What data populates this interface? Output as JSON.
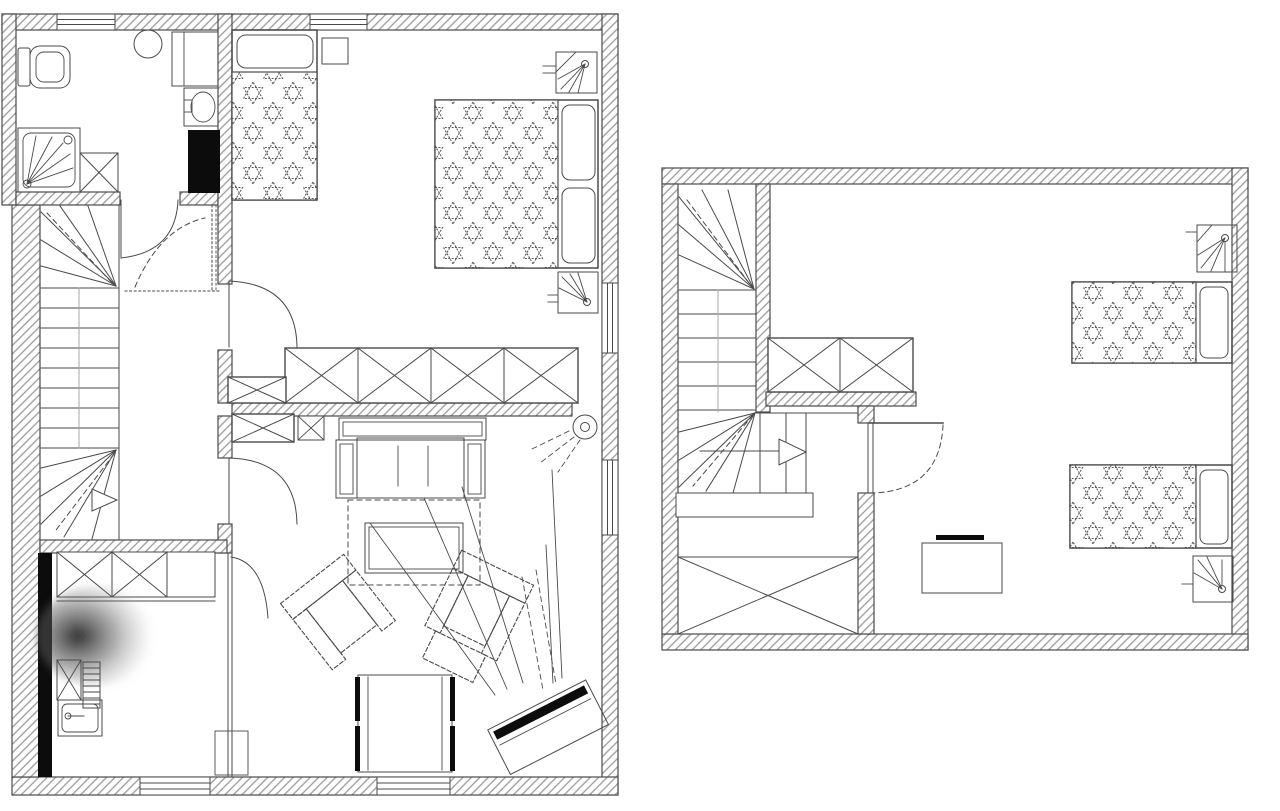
{
  "document": {
    "type": "architectural-floor-plan",
    "drawing_style": "black-and-white line drawing, hatched walls, star-patterned bedding",
    "floors": [
      {
        "name": "ground-floor",
        "position": "left",
        "rooms": [
          {
            "name": "bathroom",
            "fixtures": [
              "toilet",
              "round-sink",
              "washing-machine",
              "wash-basin",
              "black-duct-shaft",
              "shower-cabin",
              "crossed-cabinet",
              "door"
            ]
          },
          {
            "name": "bedroom",
            "furniture": [
              "single-bed-star-blanket",
              "nightstand",
              "double-bed-star-blanket",
              "two-pillows",
              "wall-lamp-top",
              "wall-lamp-side",
              "long-wardrobe-4-sections",
              "corner-wardrobe",
              "door"
            ]
          },
          {
            "name": "stair-hall",
            "features": [
              "winder-staircase",
              "direction-arrow",
              "bathroom-door-swing",
              "dashed-door-swing"
            ]
          },
          {
            "name": "living-room",
            "furniture": [
              "sofa",
              "dashed-rug",
              "coffee-table",
              "armchair-left",
              "armchair-right-with-ottoman",
              "square-seat",
              "tv-on-stand",
              "ceiling-light",
              "crossed-cabinets",
              "door"
            ]
          },
          {
            "name": "utility-room",
            "furniture": [
              "wardrobe-with-crosses",
              "black-duct-strip",
              "crossed-cabinet",
              "radiator",
              "sink-counter",
              "doormat",
              "door",
              "scan-smudge"
            ]
          }
        ],
        "windows": {
          "top": 2,
          "right": 2,
          "bottom": 2
        }
      },
      {
        "name": "upper-floor",
        "position": "right",
        "rooms": [
          {
            "name": "stair-hall",
            "features": [
              "winder-staircase",
              "landing-balustrade",
              "handrail-platform",
              "direction-arrow",
              "wardrobe-2-sections",
              "large-crossed-closet"
            ]
          },
          {
            "name": "bedroom",
            "furniture": [
              "single-bed-a-star-blanket",
              "single-bed-b-star-blanket",
              "wall-lamp-a",
              "wall-lamp-b",
              "desk",
              "laptop",
              "door-dashed-swing"
            ]
          }
        ],
        "windows": {
          "top": 0,
          "right": 0,
          "bottom": 0
        }
      }
    ]
  },
  "colors": {
    "line": "#4a4a4a",
    "hatch": "#9a9a9a",
    "ink": "#0c0c0c",
    "bg": "#ffffff",
    "starline": "#5a5a5a",
    "faint": "#aaaaaa"
  }
}
